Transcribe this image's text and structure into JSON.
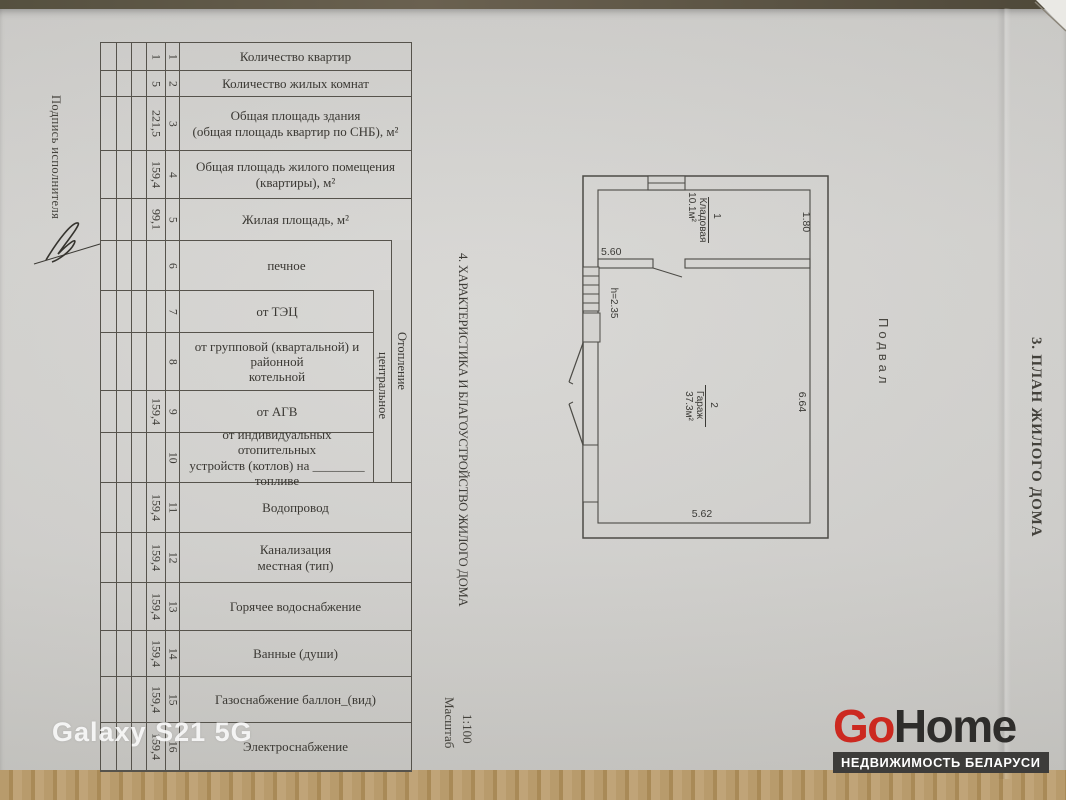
{
  "page": {
    "signature_label": "Подпись исполнителя",
    "section3_title": "3. ПЛАН ЖИЛОГО ДОМА",
    "section4_title": "4. ХАРАКТЕРИСТИКА И БЛАГОУСТРОЙСТВО ЖИЛОГО ДОМА",
    "scale_label": "Масштаб",
    "scale_value": "1:100",
    "basement_label": "Подвал"
  },
  "table": {
    "heating_group_label": "Отопление",
    "heating_central_label": "центральное",
    "rows": [
      {
        "num": "1",
        "value": "1",
        "label": "Количество квартир"
      },
      {
        "num": "2",
        "value": "5",
        "label": "Количество жилых комнат"
      },
      {
        "num": "3",
        "value": "221,5",
        "label": "Общая площадь здания\n(общая площадь квартир по СНБ), м²"
      },
      {
        "num": "4",
        "value": "159,4",
        "label": "Общая площадь жилого помещения\n(квартиры), м²"
      },
      {
        "num": "5",
        "value": "99,1",
        "label": "Жилая площадь, м²"
      },
      {
        "num": "6",
        "value": "",
        "label": "печное"
      },
      {
        "num": "7",
        "value": "",
        "label": "от ТЭЦ"
      },
      {
        "num": "8",
        "value": "",
        "label": "от групповой (квартальной) и\nрайонной\nкотельной"
      },
      {
        "num": "9",
        "value": "159,4",
        "label": "от АГВ"
      },
      {
        "num": "10",
        "value": "",
        "label": "от индивидуальных отопительных\nустройств (котлов)  на ________\nтопливе"
      },
      {
        "num": "11",
        "value": "159,4",
        "label": "Водопровод"
      },
      {
        "num": "12",
        "value": "159,4",
        "label": "Канализация\nместная (тип)"
      },
      {
        "num": "13",
        "value": "159,4",
        "label": "Горячее водоснабжение"
      },
      {
        "num": "14",
        "value": "159,4",
        "label": "Ванные (души)"
      },
      {
        "num": "15",
        "value": "159,4",
        "label": "Газоснабжение баллон_(вид)"
      },
      {
        "num": "16",
        "value": "159,4",
        "label": "Электроснабжение"
      }
    ]
  },
  "plan": {
    "room1": {
      "number": "1",
      "name": "Кладовая",
      "area": "10.1м²"
    },
    "room2": {
      "number": "2",
      "name": "Гараж",
      "area": "37.3м²"
    },
    "dims": {
      "storeroom_width": "5.60",
      "storeroom_depth": "1.80",
      "garage_depth": "6.64",
      "garage_width": "5.62",
      "ceiling_height": "h=2.35"
    }
  },
  "watermarks": {
    "device_label": "Galaxy S21 5G",
    "brand": {
      "part1": "Go",
      "part2": "Home",
      "tagline": "НЕДВИЖИМОСТЬ БЕЛАРУСИ",
      "accent_color": "#cc2920",
      "bar_color": "#3d3c3a"
    }
  }
}
